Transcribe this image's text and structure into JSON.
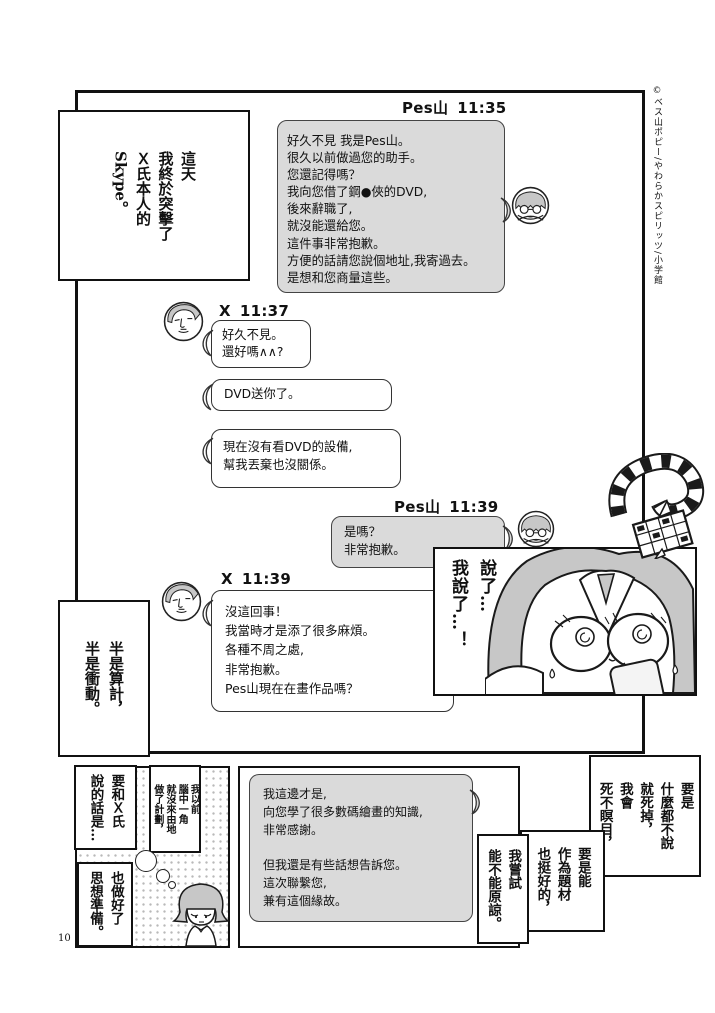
{
  "page": {
    "number": "10",
    "copyright": "©ベス山ポピー/やわらかスピリッツ/小学館"
  },
  "narration": {
    "intro": {
      "columns": [
        "這天",
        "我終於突擊了",
        "Ｘ氏本人的",
        "Skype。"
      ]
    },
    "half": {
      "columns": [
        "半是算計，",
        "半是衝動。"
      ]
    },
    "closeup": {
      "columns": [
        "說了…",
        "我說了…！"
      ]
    },
    "talk": {
      "columns": [
        "要和Ｘ氏",
        "說的話是…"
      ]
    },
    "plan": {
      "columns": [
        "我以前",
        "腦中一角",
        "就沒來由地",
        "做了計劃，"
      ]
    },
    "prepare": {
      "columns": [
        "也做好了",
        "思想準備。"
      ]
    },
    "die": {
      "columns": [
        "要是",
        "什麼都不說",
        "就死掉，",
        "我會",
        "死不瞑目，"
      ]
    },
    "material": {
      "columns": [
        "要是能",
        "作為題材",
        "也挺好的，"
      ]
    },
    "forgive": {
      "columns": [
        "我嘗試",
        "能不能原諒。"
      ]
    }
  },
  "chat": {
    "pes1": {
      "sender": "Pes山",
      "time": "11:35",
      "text": "好久不見 我是Pes山。\n很久以前做過您的助手。\n您還記得嗎？\n我向您借了鋼●俠的DVD,\n後來辭職了,\n就沒能還給您。\n這件事非常抱歉。\n方便的話請您說個地址,我寄過去。\n是想和您商量這些。"
    },
    "x1": {
      "sender": "X",
      "time": "11:37"
    },
    "x1a": {
      "text": "好久不見。\n還好嗎∧∧?"
    },
    "x1b": {
      "text": "DVD送你了。"
    },
    "x1c": {
      "text": "現在沒有看DVD的設備,\n幫我丟棄也沒關係。"
    },
    "pes2": {
      "sender": "Pes山",
      "time": "11:39",
      "text": "是嗎？\n非常抱歉。"
    },
    "x2": {
      "sender": "X",
      "time": "11:39"
    },
    "x2a": {
      "text": "沒這回事！\n我當時才是添了很多麻煩。\n各種不周之處,\n非常抱歉。\nPes山現在在畫作品嗎？"
    },
    "x2b": {
      "text": "我這邊才是,\n向您學了很多數碼繪畫的知識,\n非常感謝。\n\n但我還是有些話想告訴您。\n這次聯繫您,\n兼有這個緣故。"
    }
  },
  "colors": {
    "bubble_gray": "#dadada",
    "hair_gray": "#c7c7c7",
    "ink": "#111111"
  }
}
